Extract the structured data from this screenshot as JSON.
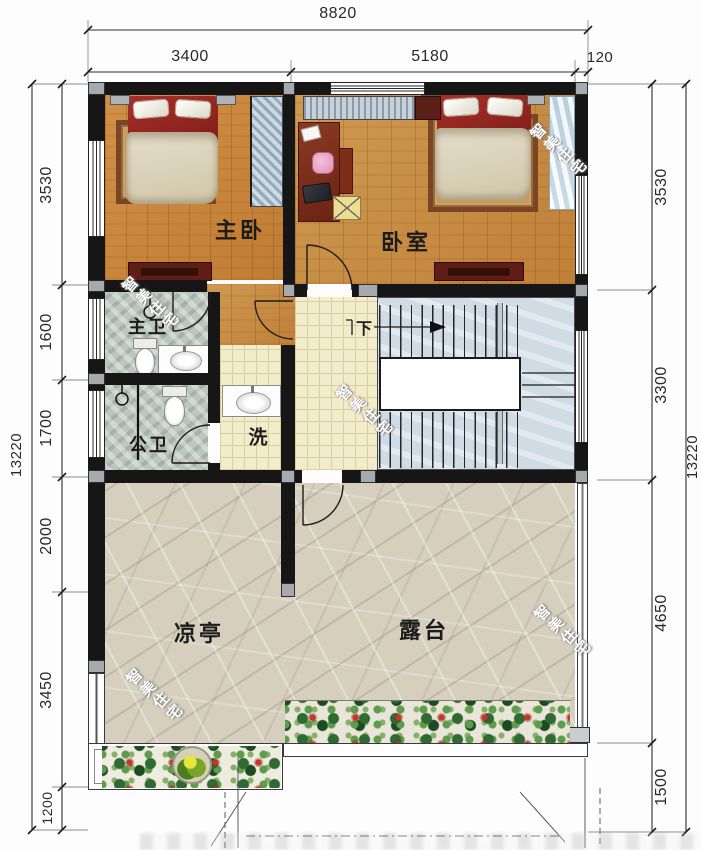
{
  "plan": {
    "title": "二层平面图",
    "watermark": {
      "text": "智美住宅"
    }
  },
  "dimensions": {
    "top": {
      "total": "8820",
      "segments": [
        "3400",
        "5180",
        "120"
      ]
    },
    "left": {
      "total": "13220",
      "segments": [
        "3530",
        "1600",
        "1700",
        "2000",
        "3450",
        "1200"
      ]
    },
    "right": {
      "total": "13220",
      "segments": [
        "3530",
        "3300",
        "4650",
        "1500"
      ]
    }
  },
  "rooms": {
    "master_bedroom": "主卧",
    "bedroom": "卧室",
    "master_bath": "主卫",
    "public_bath": "公卫",
    "wash": "洗",
    "stairs_down": "下",
    "pavilion": "凉亭",
    "terrace": "露台"
  },
  "colors": {
    "wall": "#161616",
    "column": "#a6a9ae",
    "wood_floor": "#c98a3f",
    "bath_tile": "#bcc6bf",
    "hall_tile": "#f3ecca",
    "stair_marble": "#cfdbe5",
    "terrace_stone": "#d6cfbd",
    "bed_red": "#97231f",
    "accent_flower": "#c2372a"
  }
}
